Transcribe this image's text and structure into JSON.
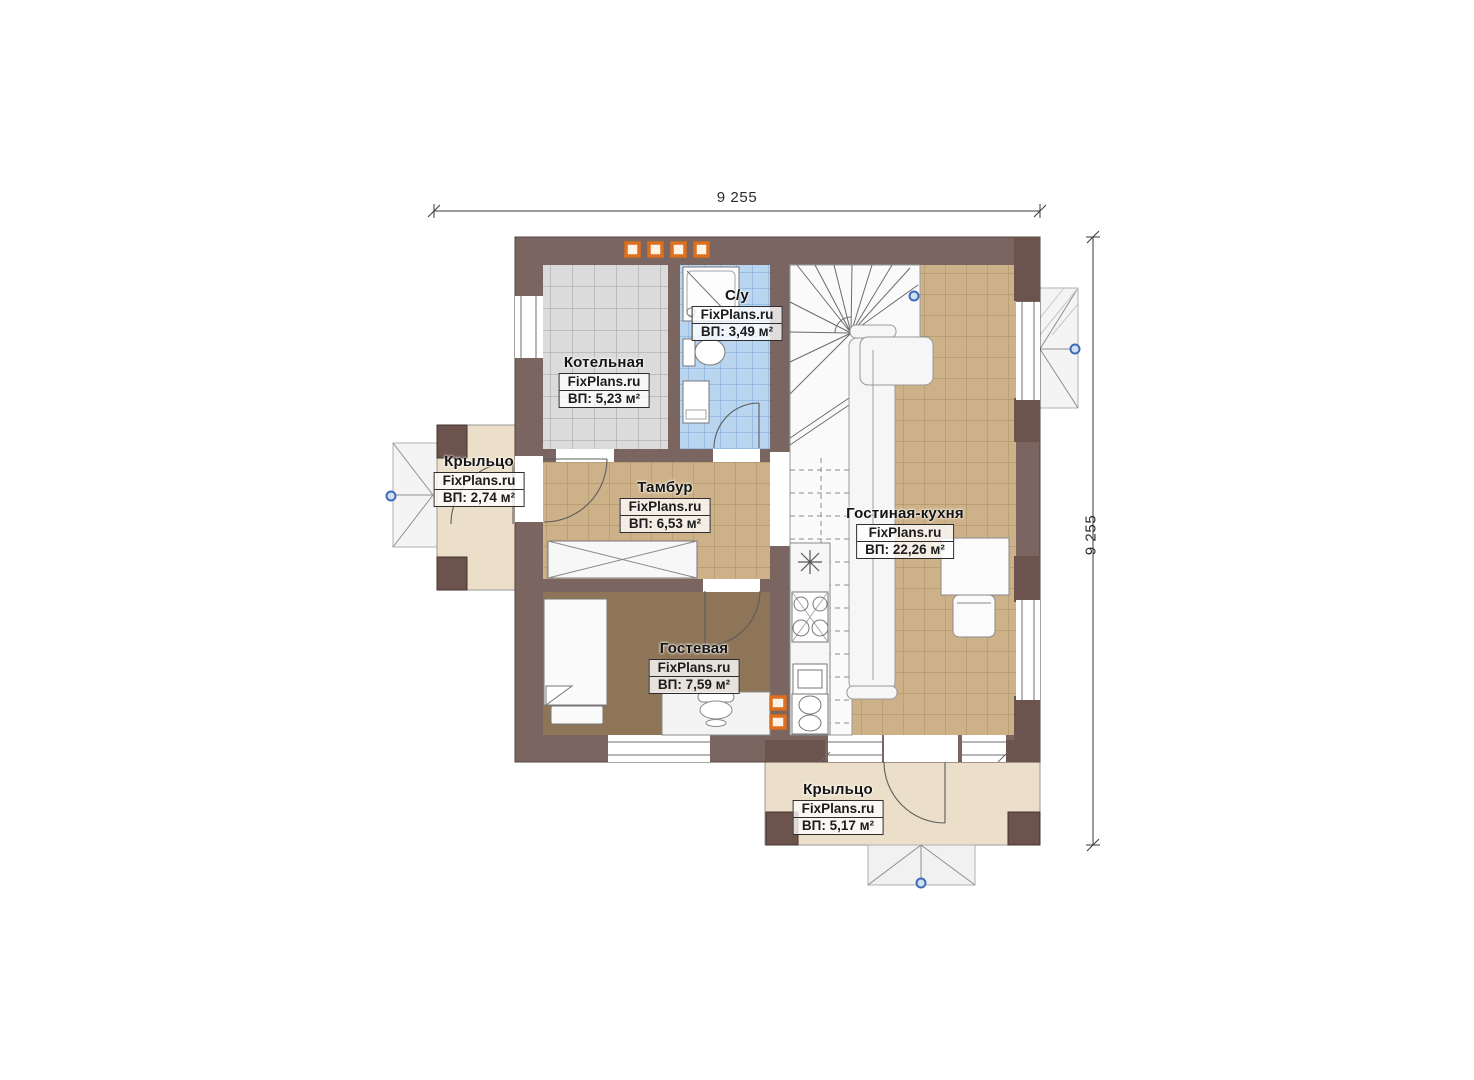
{
  "dimensions": {
    "top": "9 255",
    "right": "9 255"
  },
  "watermark": "FixPlans.ru",
  "rooms": [
    {
      "key": "kotelnaya",
      "title": "Котельная",
      "brand": "FixPlans.ru",
      "area": "ВП: 5,23 м²"
    },
    {
      "key": "su",
      "title": "С/у",
      "brand": "FixPlans.ru",
      "area": "ВП: 3,49 м²"
    },
    {
      "key": "tambur",
      "title": "Тамбур",
      "brand": "FixPlans.ru",
      "area": "ВП: 6,53 м²"
    },
    {
      "key": "gostinaya_kuhnya",
      "title": "Гостиная-кухня",
      "brand": "FixPlans.ru",
      "area": "ВП: 22,26 м²"
    },
    {
      "key": "gostevaya",
      "title": "Гостевая",
      "brand": "FixPlans.ru",
      "area": "ВП: 7,59 м²"
    },
    {
      "key": "porch_left",
      "title": "Крыльцо",
      "brand": "FixPlans.ru",
      "area": "ВП: 2,74 м²"
    },
    {
      "key": "porch_bottom",
      "title": "Крыльцо",
      "brand": "FixPlans.ru",
      "area": "ВП: 5,17 м²"
    }
  ],
  "colors": {
    "wall": "#7a6561",
    "pillar": "#6c534e",
    "tile_gray": "#dbdbdb",
    "tile_blue": "#bad5f0",
    "tile_tan": "#cdb289",
    "carpet": "#8e7557",
    "porch": "#ecdfc9",
    "accent_orange": "#dd6f1e",
    "marker_blue": "#3f6cb5"
  }
}
